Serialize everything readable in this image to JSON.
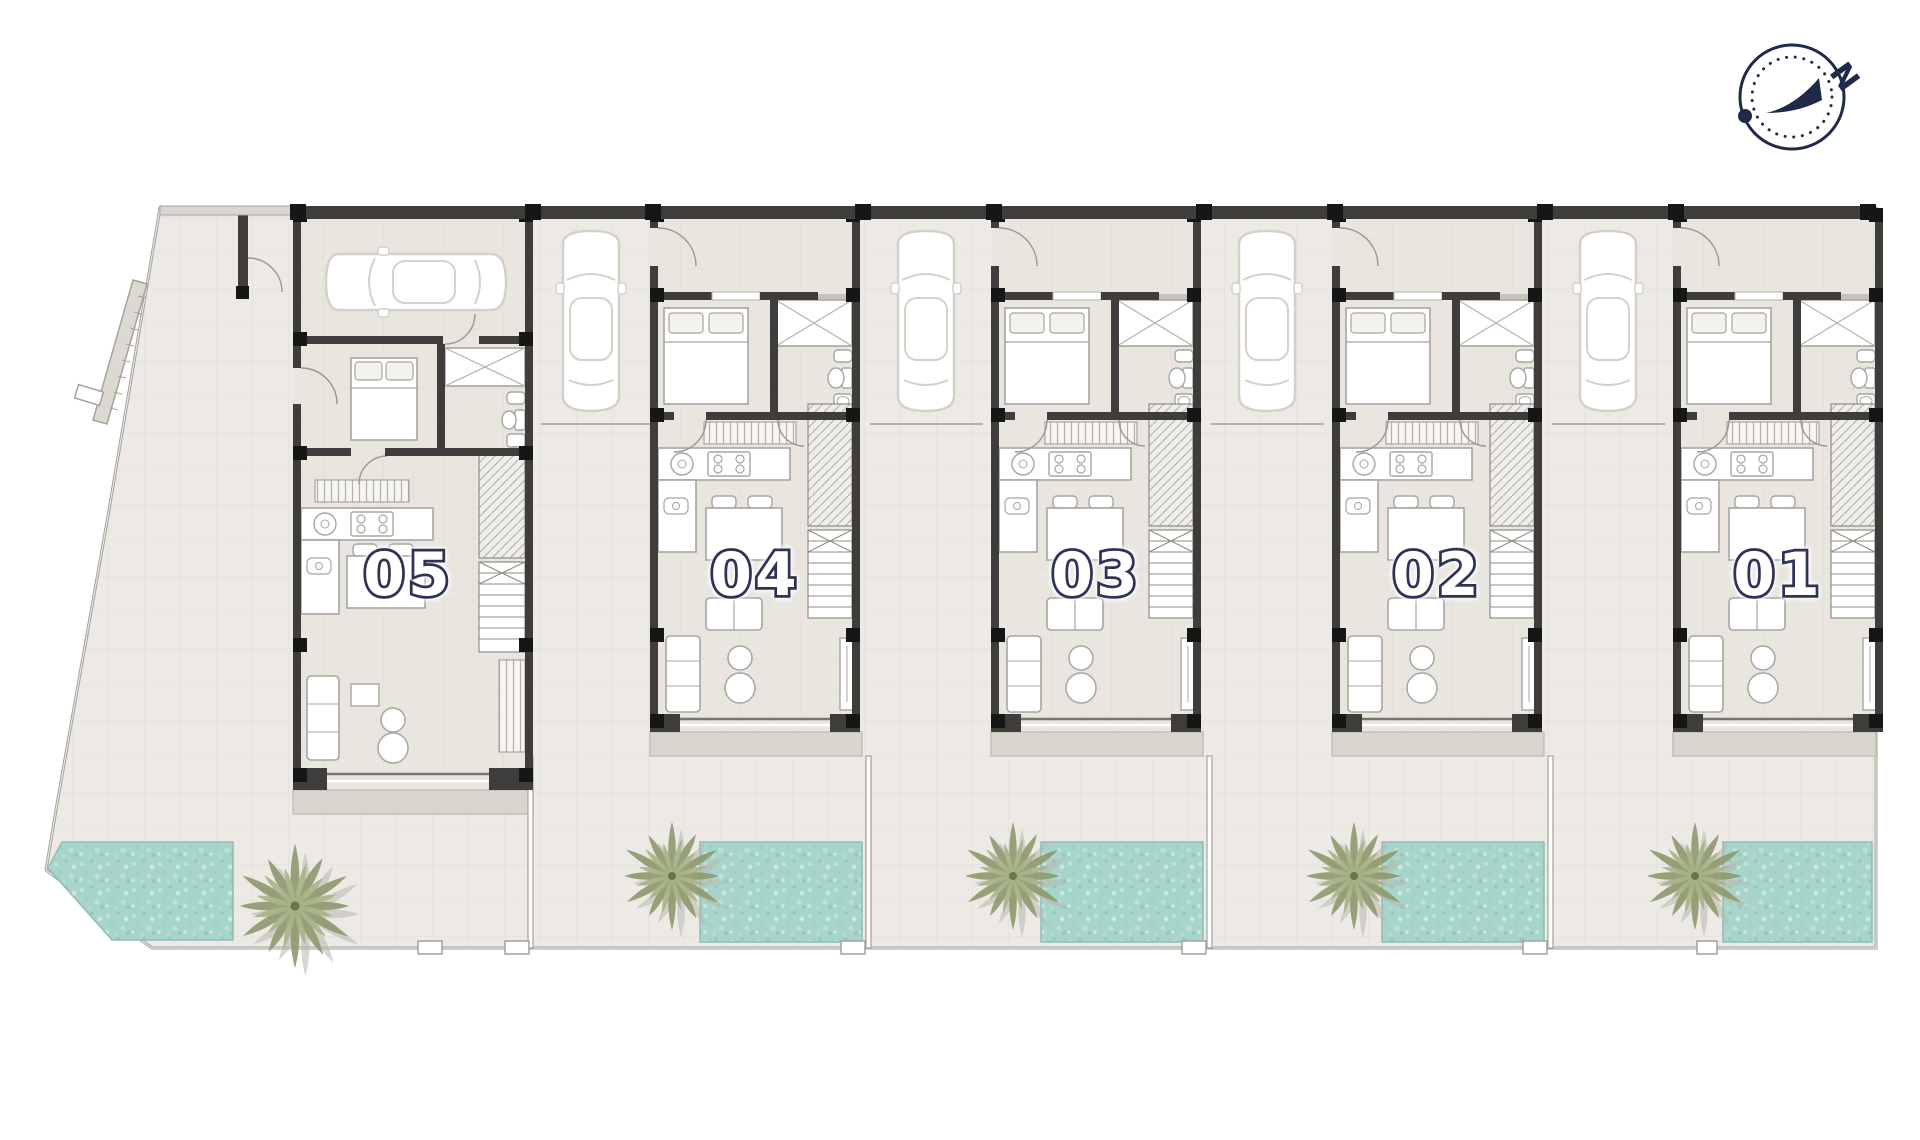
{
  "plan": {
    "units": [
      {
        "number": "05"
      },
      {
        "number": "04"
      },
      {
        "number": "03"
      },
      {
        "number": "02"
      },
      {
        "number": "01"
      }
    ],
    "compass": {
      "north_label": "N"
    },
    "colors": {
      "wall": "#3e3d3b",
      "wall_accent": "#161616",
      "pool_water": "#a7d5cb",
      "palm_foliage": "#8e9a6e",
      "label_fill": "#ffffff",
      "label_outline": "#2e3355",
      "compass_navy": "#20294a",
      "interior_floor": "#e9e6e0",
      "exterior_paving": "#edeae5",
      "terrace": "#d8d5ce"
    }
  }
}
